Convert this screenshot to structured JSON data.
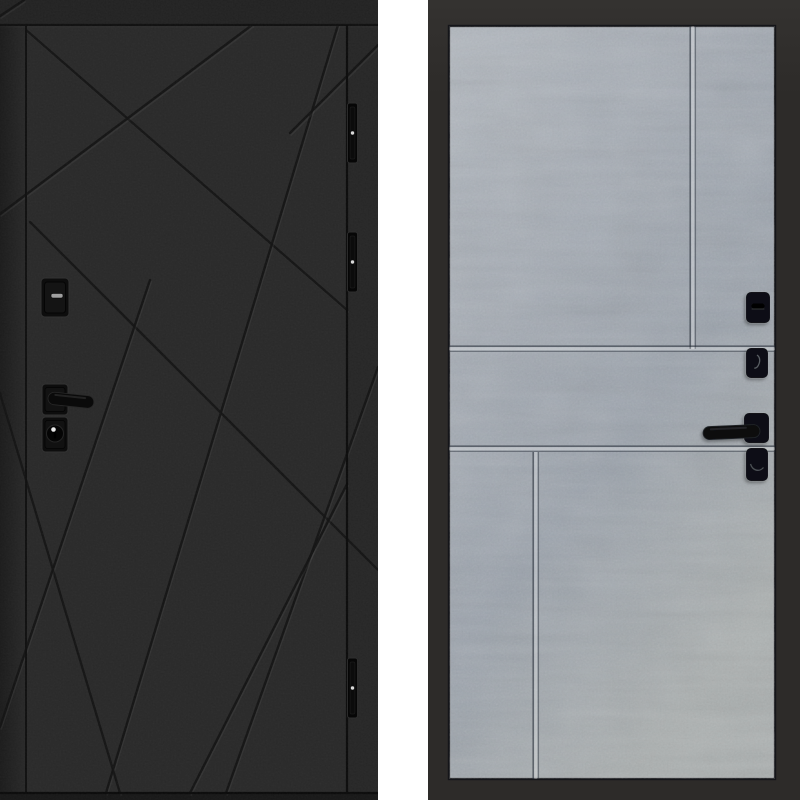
{
  "image_type": "product-photo",
  "subject": "steel entry door shown from both sides",
  "canvas": {
    "w": 800,
    "h": 800,
    "background": "#ffffff"
  },
  "divider": {
    "x": 378,
    "w": 50,
    "color": "#ffffff"
  },
  "front_door": {
    "side": "exterior-black-panel",
    "rect": {
      "x": 0,
      "y": 0,
      "w": 378,
      "h": 800
    },
    "colors": {
      "body": "#292929",
      "top_strip": "#222222",
      "left_strip_dark": "#1b1b1b",
      "left_strip_light": "#282828",
      "right_strip": "#262626",
      "bottom_strip": "#171717",
      "border_line": "#0f0f0f",
      "groove": "#121212",
      "groove_highlight": "rgba(255,255,255,0.05)",
      "hardware": "#0d0d0d",
      "hardware_bevel": "#323232",
      "screw_dot": "#d8d8d8",
      "slot_light": "#9f9f9f"
    },
    "leaf": {
      "x1": 26,
      "y1": 25,
      "x2": 347,
      "y2": 793
    },
    "grooves": [
      [
        26,
        30,
        347,
        310
      ],
      [
        252,
        25,
        0,
        214
      ],
      [
        338,
        25,
        106,
        793
      ],
      [
        30,
        222,
        378,
        570
      ],
      [
        378,
        367,
        226,
        793
      ],
      [
        378,
        45,
        290,
        133
      ],
      [
        0,
        393,
        120,
        793
      ],
      [
        150,
        280,
        0,
        727
      ],
      [
        347,
        484,
        190,
        793
      ],
      [
        0,
        16,
        24,
        0
      ]
    ],
    "hinges": {
      "x": 347.5,
      "w": 10,
      "h": 60,
      "ys": [
        103,
        232,
        658
      ]
    },
    "thumbturn": {
      "x": 41,
      "y": 278,
      "w": 28,
      "h": 39,
      "slot": {
        "x": 51,
        "y": 293.5,
        "w": 12,
        "h": 4.5
      }
    },
    "handle": {
      "rose": {
        "x": 42,
        "y": 384,
        "w": 26,
        "h": 31
      },
      "lever": {
        "x": 48,
        "y": 392,
        "len": 46,
        "th": 12.5,
        "angle": 6
      }
    },
    "cylinder": {
      "x": 42,
      "y": 417,
      "w": 26,
      "h": 35,
      "ring": {
        "cx": 55,
        "cy": 433.5,
        "r": 8.5
      },
      "dot": {
        "cx": 53.5,
        "cy": 429.5,
        "r": 2.3
      }
    }
  },
  "back_door": {
    "side": "interior-concrete-panel",
    "rect": {
      "x": 428,
      "y": 0,
      "w": 372,
      "h": 800
    },
    "frame_color": "#2d2b29",
    "frame_color_light": "#343230",
    "panel": {
      "x": 449,
      "y": 26,
      "w": 326,
      "h": 753,
      "border": "#141519",
      "gradient": [
        "#b2b8bf",
        "#a3aab3",
        "#99a1ab",
        "#a9aeae"
      ]
    },
    "groove_dark": "rgba(44,50,60,0.6)",
    "groove_light": "rgba(255,255,255,0.28)",
    "grooves": [
      {
        "o": "v",
        "x": 693,
        "y1": 26,
        "y2": 349
      },
      {
        "o": "h",
        "y": 349,
        "x1": 449,
        "x2": 775
      },
      {
        "o": "h",
        "y": 449,
        "x1": 449,
        "x2": 775
      },
      {
        "o": "v",
        "x": 536,
        "y1": 452,
        "y2": 779
      }
    ],
    "hardware": {
      "color": "#0f1114",
      "edge": "rgba(255,255,255,0.07)",
      "mark": "rgba(165,172,182,0.5)",
      "thumbturn": {
        "x": 746,
        "y": 292,
        "w": 24,
        "h": 31,
        "slot": {
          "x": 751.5,
          "y": 303.5,
          "w": 13,
          "h": 5
        }
      },
      "keyhole_top": {
        "x": 746,
        "y": 348,
        "w": 22,
        "h": 30
      },
      "handle": {
        "plate": {
          "x": 744,
          "y": 413,
          "w": 25,
          "h": 30
        },
        "lever": {
          "x": 703,
          "y": 424.5,
          "len": 57,
          "th": 13,
          "angle": -2.5
        }
      },
      "keyhole_bottom": {
        "x": 746,
        "y": 448,
        "w": 22,
        "h": 33
      }
    }
  }
}
